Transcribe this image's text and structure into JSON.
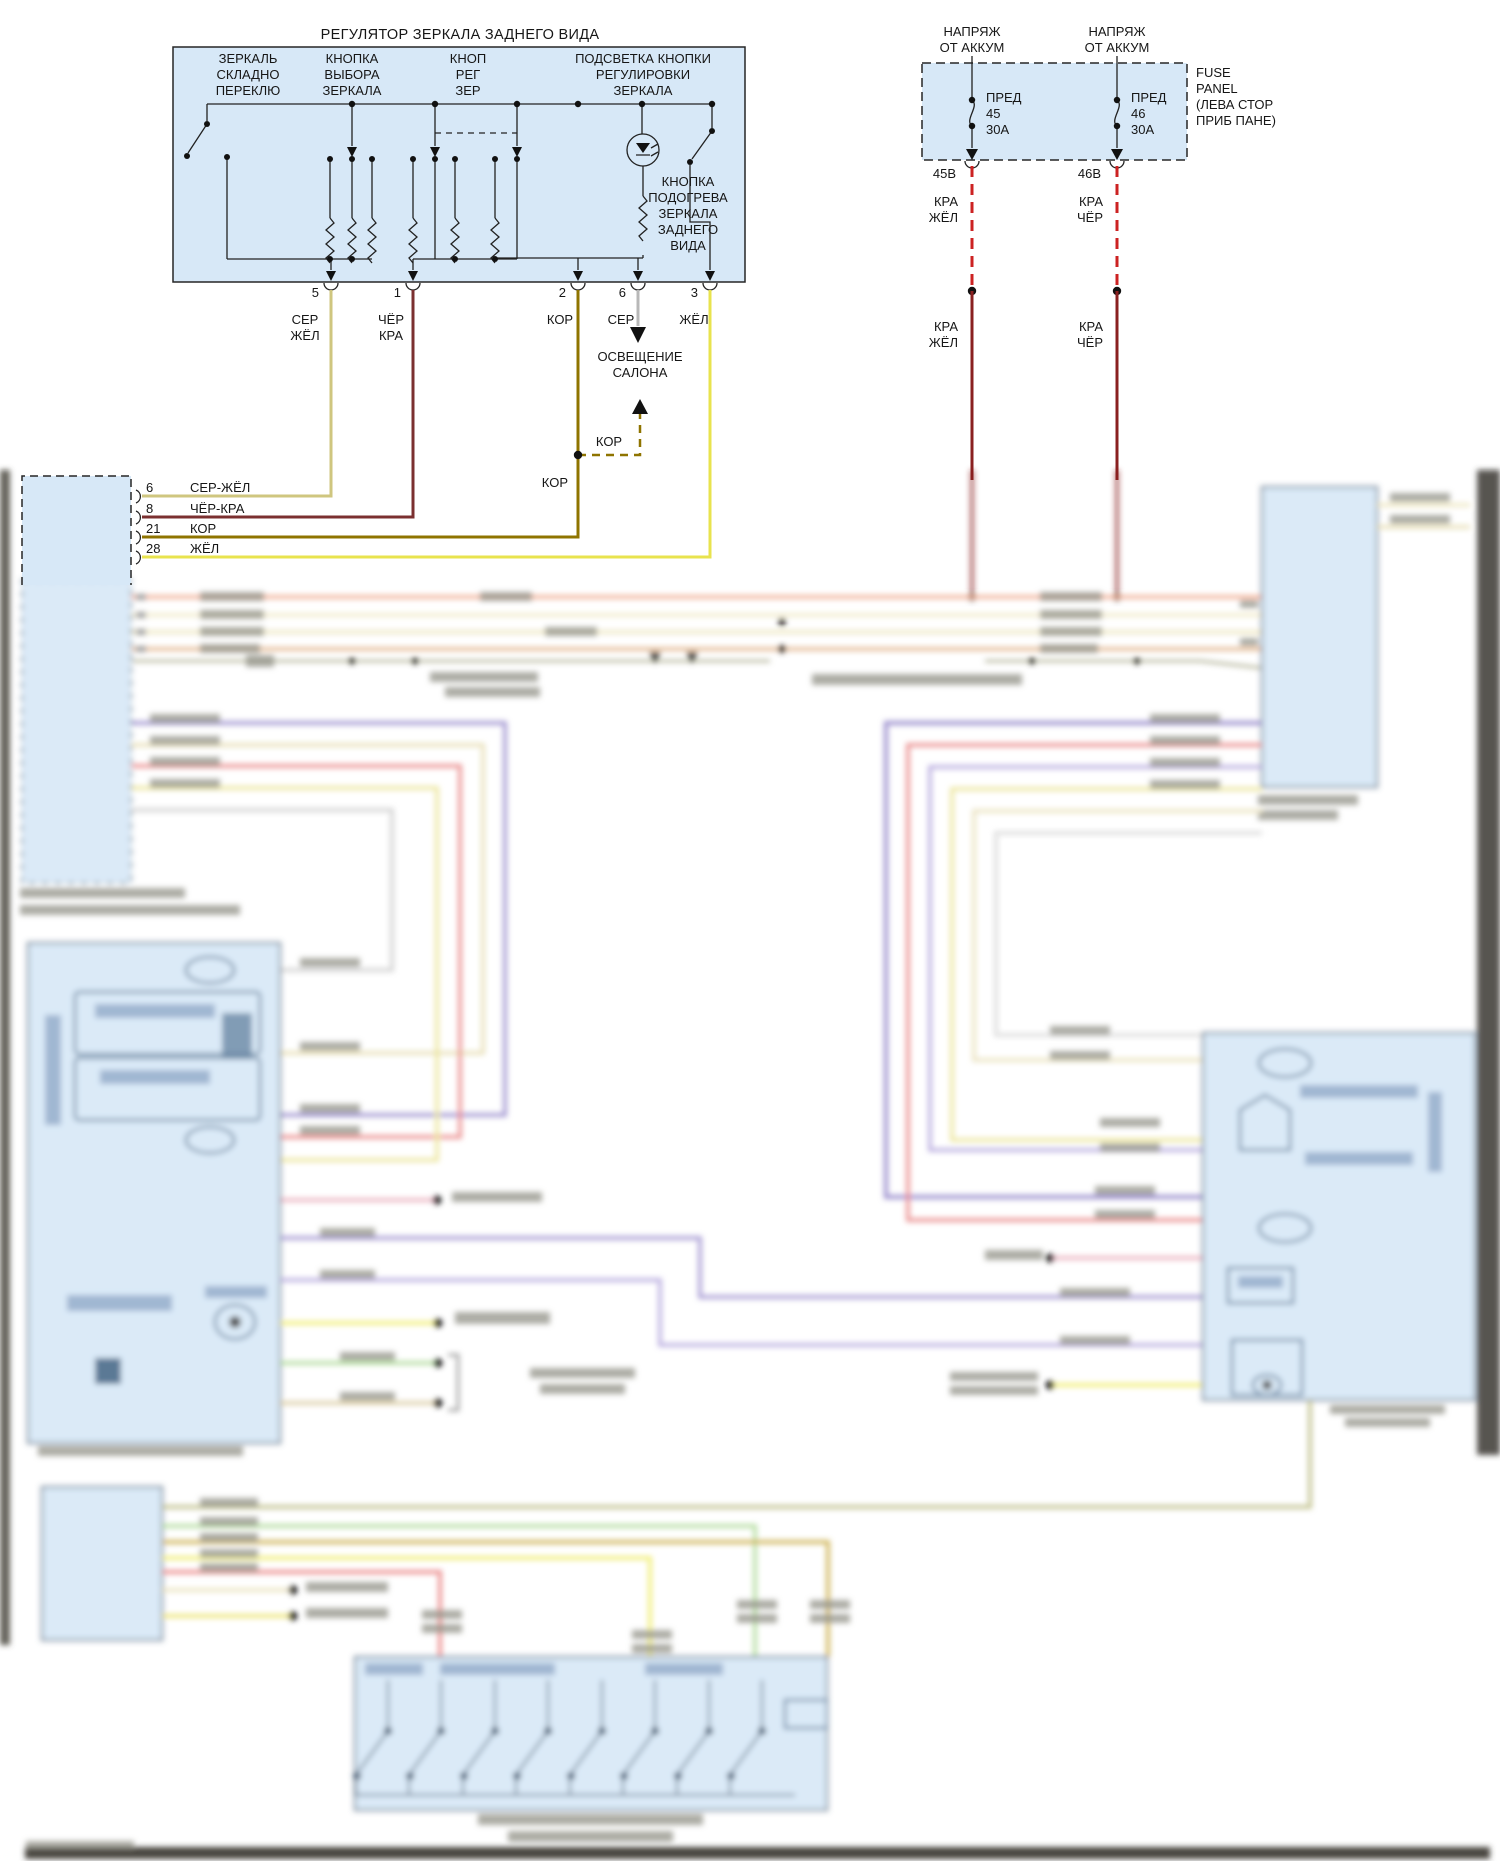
{
  "diagram": {
    "title": "РЕГУЛЯТОР ЗЕРКАЛА ЗАДНЕГО ВИДА",
    "mirror_block": {
      "fold_switch": [
        "ЗЕРКАЛЬ",
        "СКЛАДНО",
        "ПЕРЕКЛЮ"
      ],
      "select_switch": [
        "КНОПКА",
        "ВЫБОРА",
        "ЗЕРКАЛА"
      ],
      "adjust_switch": [
        "КНОП",
        "РЕГ",
        "ЗЕР"
      ],
      "backlight": [
        "ПОДСВЕТКА КНОПКИ",
        "РЕГУЛИРОВКИ",
        "ЗЕРКАЛА"
      ],
      "heater_switch": [
        "КНОПКА",
        "ПОДОГРЕВА",
        "ЗЕРКАЛА",
        "ЗАДНЕГО",
        "ВИДА"
      ]
    },
    "mirror_pins": {
      "p5": {
        "num": "5",
        "c1": "СЕР",
        "c2": "ЖЁЛ"
      },
      "p1": {
        "num": "1",
        "c1": "ЧЁР",
        "c2": "КРА"
      },
      "p2": {
        "num": "2",
        "c1": "КОР"
      },
      "p6": {
        "num": "6",
        "c1": "СЕР"
      },
      "p3": {
        "num": "3",
        "c1": "ЖЁЛ"
      }
    },
    "cabin_light": [
      "ОСВЕЩЕНИЕ",
      "САЛОНА"
    ],
    "kor_label": "КОР",
    "power": {
      "batt_label": [
        "НАПРЯЖ",
        "ОТ АККУМ"
      ],
      "fuse_panel": [
        "FUSE",
        "PANEL",
        "(ЛЕВА СТОР",
        "ПРИБ ПАНЕ)"
      ],
      "fuse45": [
        "ПРЕД",
        "45",
        "30А"
      ],
      "fuse46": [
        "ПРЕД",
        "46",
        "30А"
      ],
      "out45": "45В",
      "out46": "46В",
      "wire45": [
        "КРА",
        "ЖЁЛ"
      ],
      "wire46": [
        "КРА",
        "ЧЁР"
      ]
    },
    "left_connector": {
      "pins": [
        {
          "num": "6",
          "color": "СЕР-ЖЁЛ"
        },
        {
          "num": "8",
          "color": "ЧЁР-КРА"
        },
        {
          "num": "21",
          "color": "КОР"
        },
        {
          "num": "28",
          "color": "ЖЁЛ"
        }
      ]
    }
  },
  "colors": {
    "block_fill": "#d7e8f7",
    "line": "#222222",
    "wire_ser_zhel": "#cfc67f",
    "wire_chor_kra": "#7b3030",
    "wire_kor": "#8f7400",
    "wire_zhel": "#e8e34e",
    "wire_ser": "#b8b8b8",
    "wire_kra_dash": "#cc2222",
    "wire_kra_solid": "#8a2020"
  }
}
